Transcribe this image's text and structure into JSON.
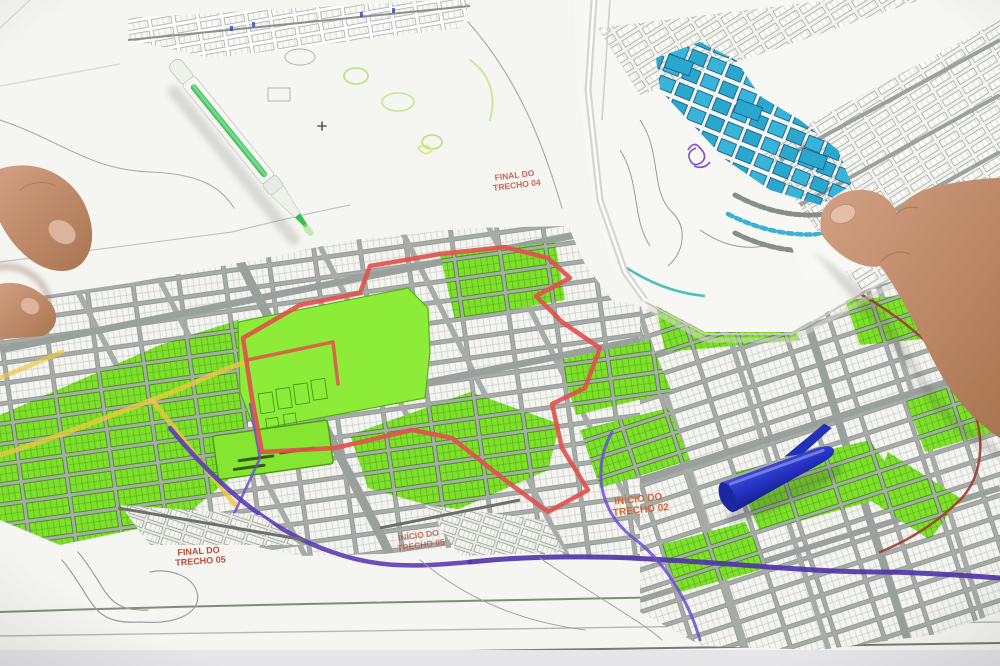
{
  "scene": {
    "description": "Photograph looking down at printed urban street maps spread on a table. A large map sheet shows a street grid with many lots highlighted in green, a route boundary traced in red, yellow and purple marker lines, and small red segment labels. A folded second sheet with cyan-highlighted blocks lies on top at the upper right, held by a right hand. Fingers of a left hand rest at the left edge. A translucent green highlighter pen and a blue pen cap lie on the maps.",
    "objects": {
      "main_map": "large printed street map sheet",
      "overlay_map": "folded map sheet with cyan highlighted blocks",
      "green_pen": "translucent green highlighter pen",
      "blue_cap": "blue pen cap",
      "left_hand": "left hand fingertips",
      "right_hand": "right hand holding folded sheet"
    }
  },
  "labels": {
    "final_trecho_04": {
      "line1": "FINAL DO",
      "line2": "TRECHO 04"
    },
    "inicio_trecho_02": {
      "line1": "INÍCIO DO",
      "line2": "TRECHO 02"
    },
    "final_trecho_05": {
      "line1": "FINAL DO",
      "line2": "TRECHO 05"
    },
    "inicio_trecho_05": {
      "line1": "INÍCIO DO",
      "line2": "TRECHO 05"
    }
  },
  "colors": {
    "paper": "#f5f5f1",
    "street_gray": "#a7aca8",
    "lot_green": "#7fe02c",
    "park_green": "#8cec38",
    "route_red": "#e2514d",
    "route_purple": "#5a3cb8",
    "route_yellow": "#ecc83f",
    "boundary_dark_red": "#9e3c2c",
    "highlight_cyan": "#38b4d8",
    "pen_ink_green": "#3dbd55",
    "pen_cap_blue": "#2433c4",
    "skin": "#c99579",
    "label_red": "#c64a3e"
  }
}
